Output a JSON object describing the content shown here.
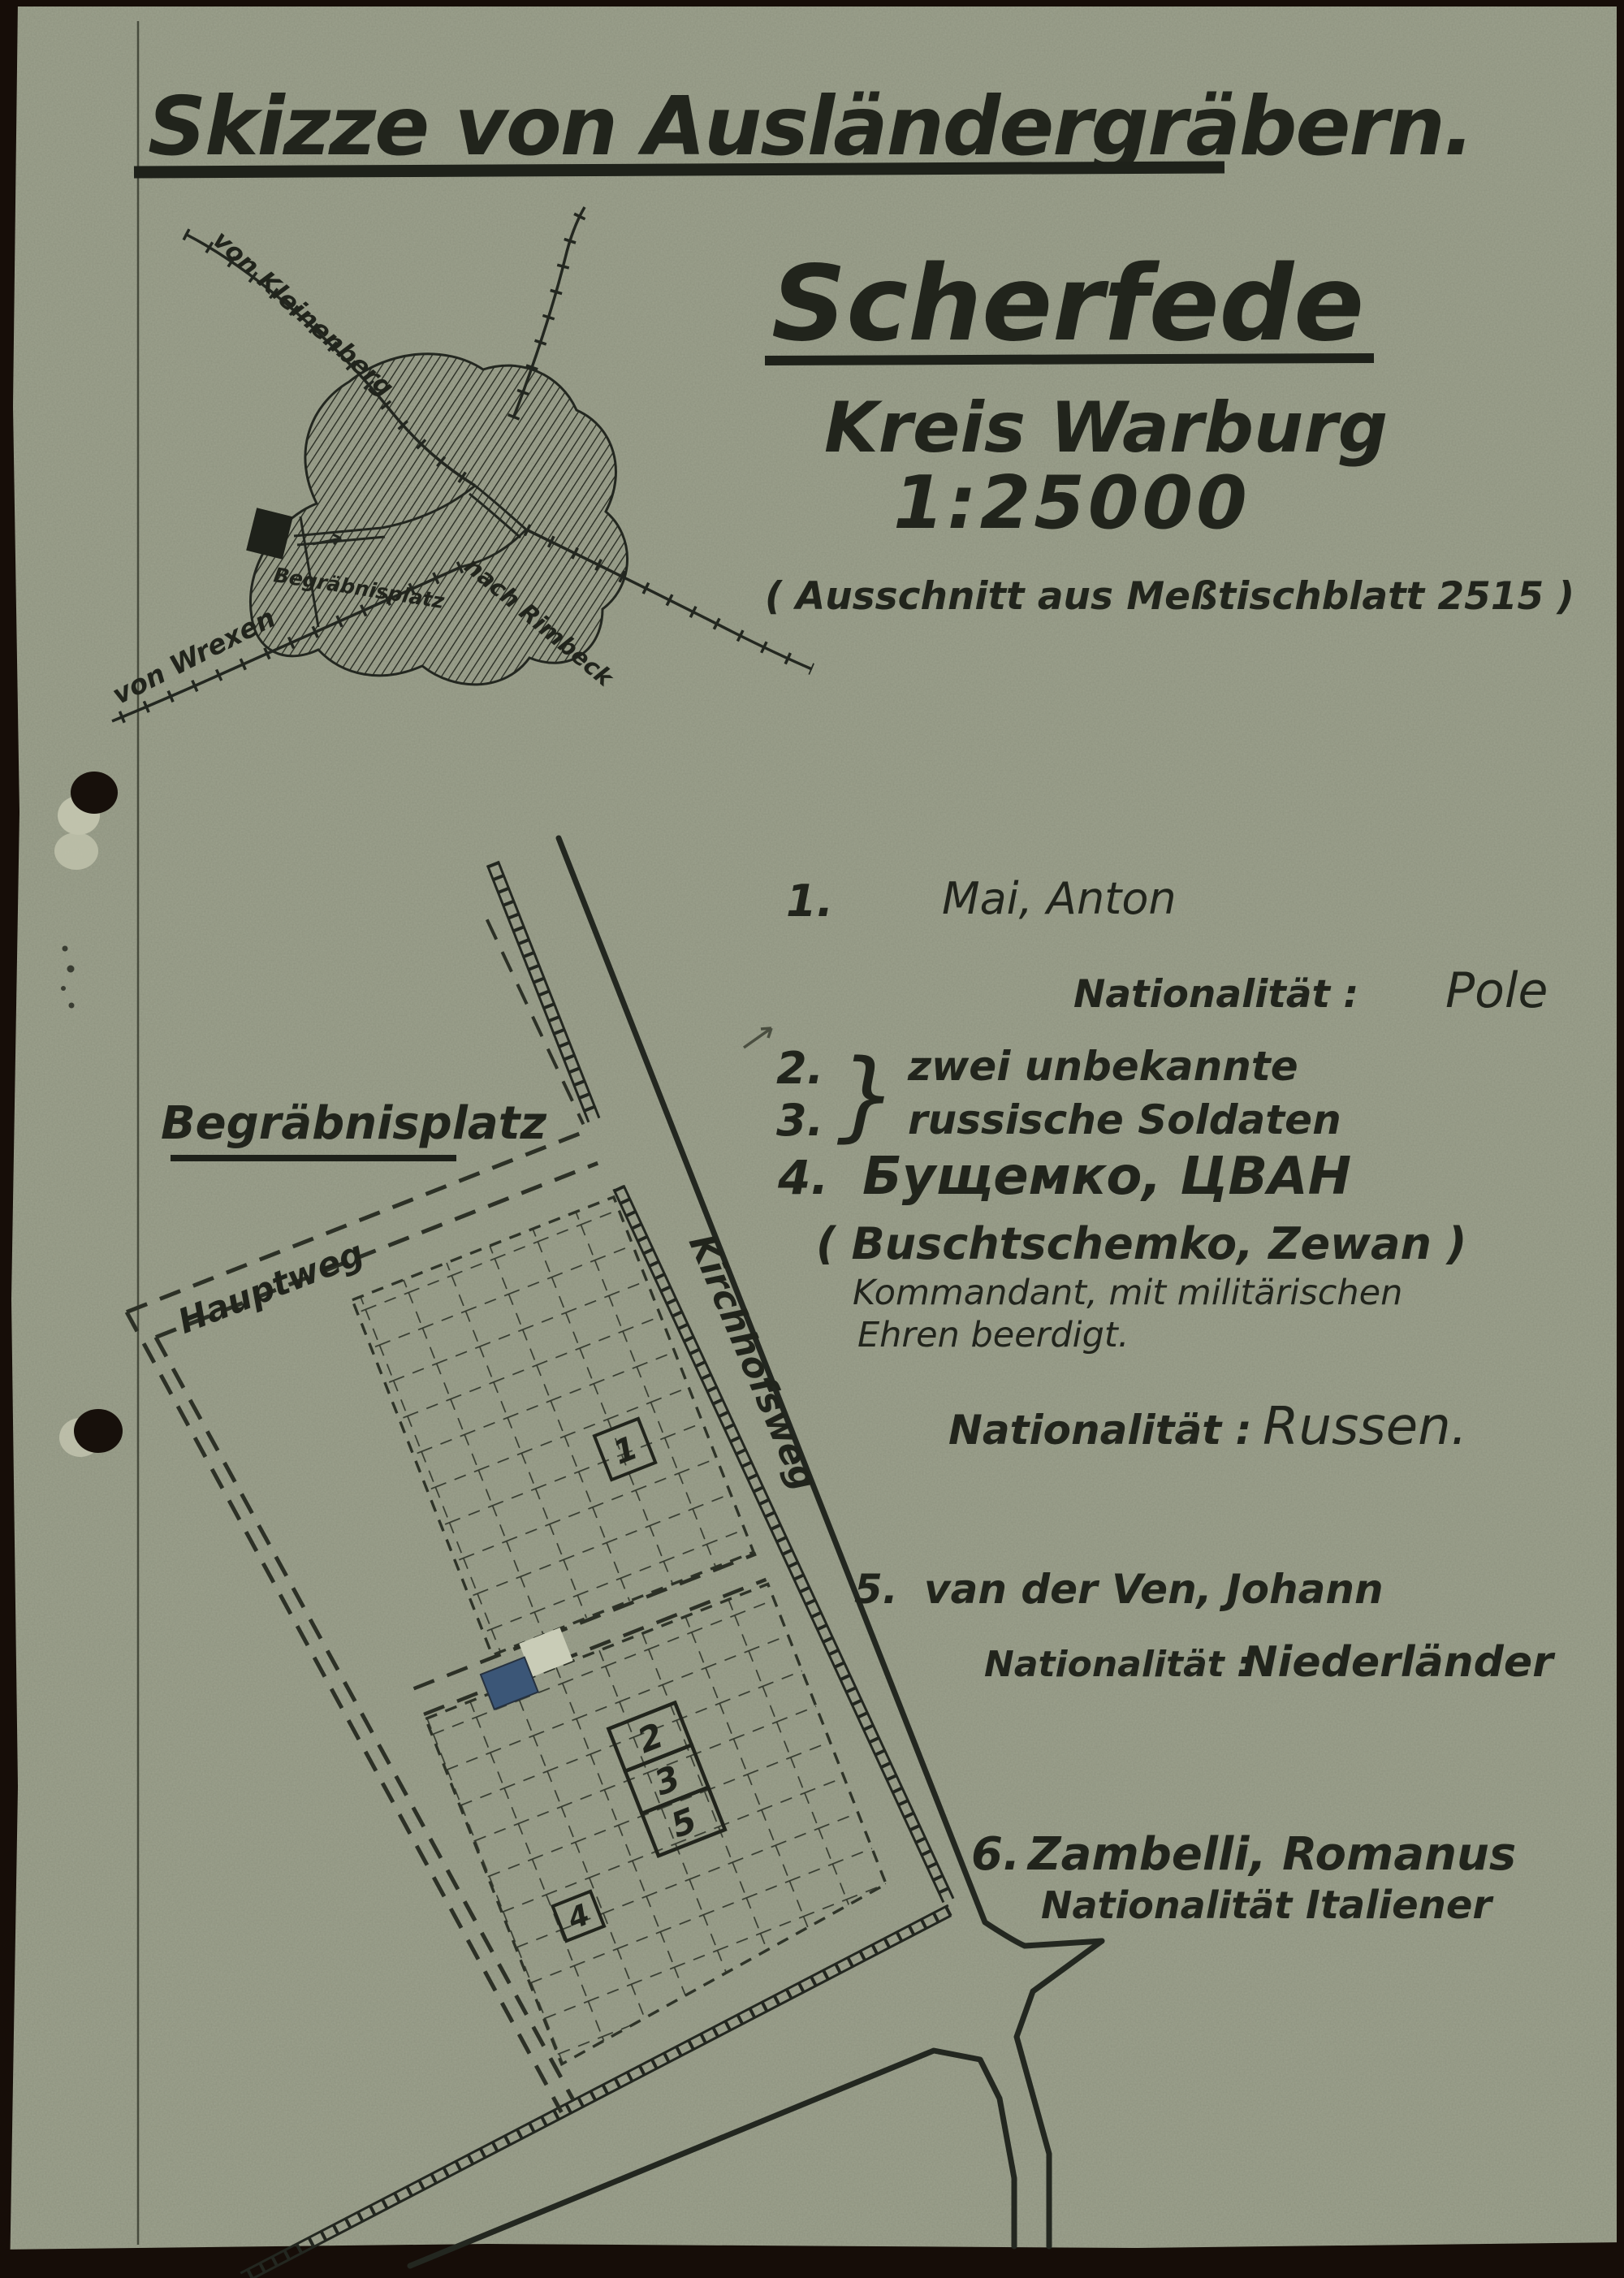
{
  "title": "Skizze von Ausländergräbern.",
  "header": {
    "place": "Scherfede",
    "district": "Kreis Warburg",
    "scale": "1:25000",
    "source_note": "( Ausschnitt aus Meßtischblatt 2515 )"
  },
  "mini_map": {
    "from_kleinenberg": "von Kleinenberg",
    "from_wrexen": "von Wrexen",
    "to_rimbeck": "nach Rimbeck",
    "burial_site": "Begräbnisplatz"
  },
  "cemetery": {
    "title": "Begräbnisplatz",
    "main_path": "Hauptweg",
    "church_path": "Kirchhofsweg",
    "plots": {
      "p1": "1",
      "p2": "2",
      "p3": "3",
      "p5": "5",
      "p4": "4"
    }
  },
  "graves": {
    "g1": {
      "no": "1.",
      "name": "Mai, Anton",
      "nat_label": "Nationalität :",
      "nationality": "Pole"
    },
    "g23": {
      "no_2": "2.",
      "no_3": "3.",
      "brace": "}",
      "line1": "zwei unbekannte",
      "line2": "russische Soldaten"
    },
    "g4": {
      "no": "4.",
      "name_cyrillic": "Бущемко, ЦВАН",
      "name_latin": "( Buschtschemko, Zewan )",
      "note1": "Kommandant, mit militärischen",
      "note2": "Ehren beerdigt.",
      "nat_label": "Nationalität :",
      "nationality": "Russen."
    },
    "g5": {
      "no": "5.",
      "name": "van der Ven, Johann",
      "nat_label": "Nationalität :",
      "nationality": "Niederländer"
    },
    "g6": {
      "no": "6.",
      "name": "Zambelli, Romanus",
      "nat_label": "Nationalität :",
      "nationality": "Italiener"
    }
  },
  "colors": {
    "paper": "#9da28e",
    "ink": "#21241c",
    "scan_background": "#160d08",
    "marked_grave_blue": "#3b5677",
    "marked_grave_light": "#c9ccb7"
  }
}
